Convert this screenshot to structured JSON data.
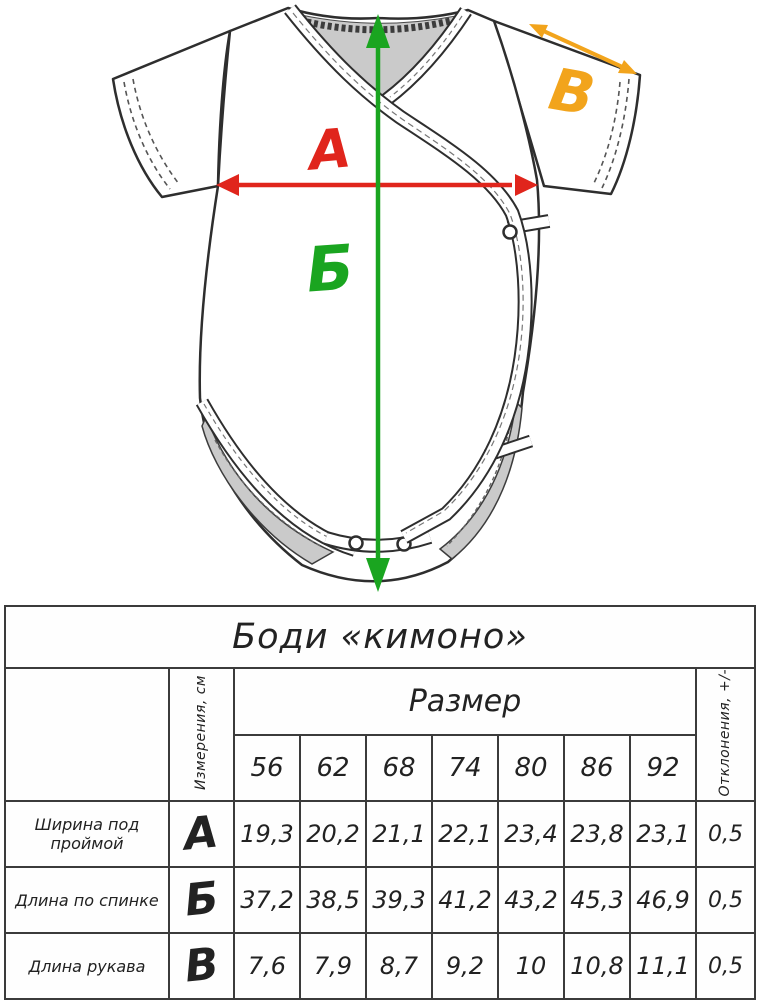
{
  "diagram": {
    "labels": {
      "a": "А",
      "b": "Б",
      "v": "В"
    },
    "arrow_colors": {
      "a": "#e0251c",
      "b": "#1aa520",
      "v": "#f2a41c"
    },
    "garment": "боди кимоно"
  },
  "table": {
    "title": "Боди «кимоно»",
    "measurements_header": "Измерения, см",
    "size_header": "Размер",
    "deviation_header": "Отклонения, +/-",
    "sizes": [
      "56",
      "62",
      "68",
      "74",
      "80",
      "86",
      "92"
    ],
    "rows": [
      {
        "name": "Ширина под проймой",
        "letter": "А",
        "color": "#dd2a20",
        "values": [
          "19,3",
          "20,2",
          "21,1",
          "22,1",
          "23,4",
          "23,8",
          "23,1"
        ],
        "deviation": "0,5"
      },
      {
        "name": "Длина по спинке",
        "letter": "Б",
        "color": "#2ea83e",
        "values": [
          "37,2",
          "38,5",
          "39,3",
          "41,2",
          "43,2",
          "45,3",
          "46,9"
        ],
        "deviation": "0,5"
      },
      {
        "name": "Длина рукава",
        "letter": "В",
        "color": "#f0a437",
        "values": [
          "7,6",
          "7,9",
          "8,7",
          "9,2",
          "10",
          "10,8",
          "11,1"
        ],
        "deviation": "0,5"
      }
    ]
  }
}
